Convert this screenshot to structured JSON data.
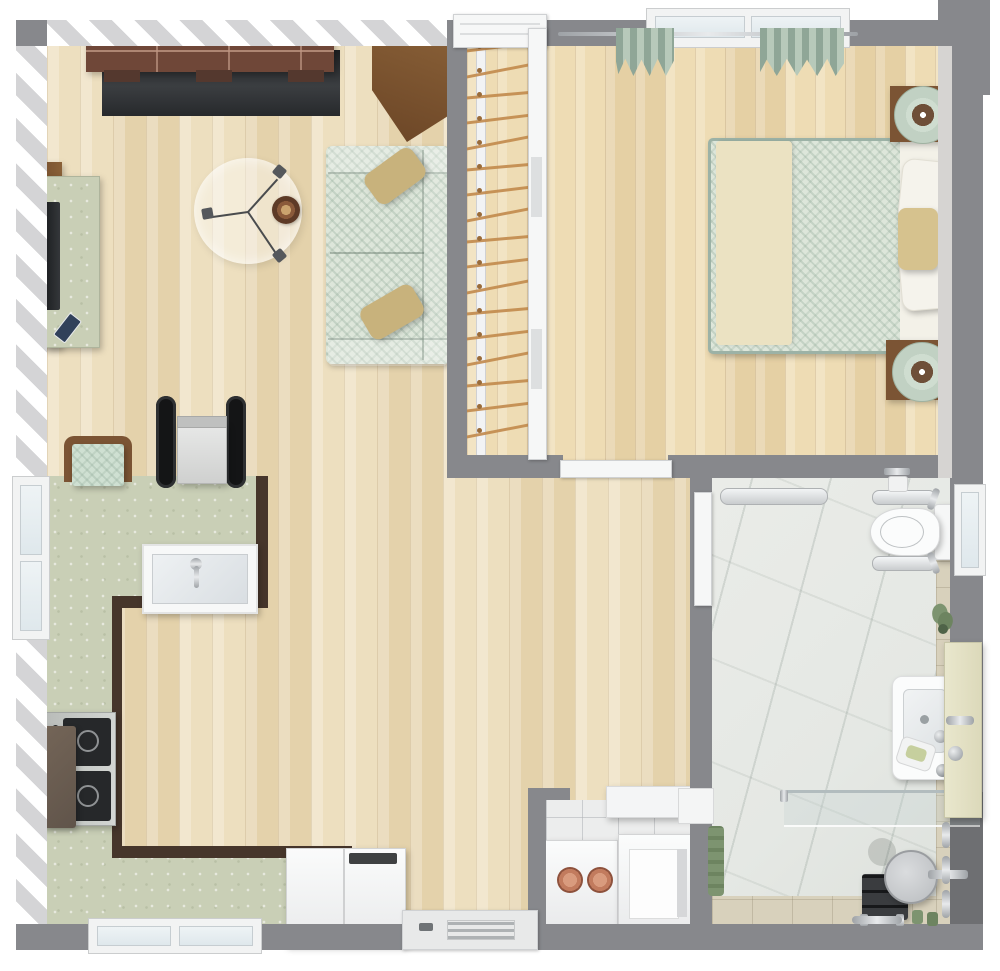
{
  "scene": {
    "title": "3D top-view floor plan — one-bedroom accessible apartment",
    "rooms": [
      {
        "name": "living-room",
        "furniture": [
          "brick fireplace mantel",
          "dark fireplace panel",
          "media sideboard",
          "flat tv",
          "remote control",
          "round glass coffee table",
          "decor bowl",
          "two-seat sofa",
          "tan throw pillows",
          "corner wood cabinet"
        ]
      },
      {
        "name": "kitchen-dining",
        "furniture": [
          "l-shaped countertop",
          "double sink with faucet",
          "gas cooktop",
          "range hood cabinet",
          "dining chair with chevron cushion",
          "wheelchair",
          "chest freezer",
          "entry door with vent"
        ]
      },
      {
        "name": "closet",
        "furniture": [
          "closet rod",
          "clothes hangers",
          "sliding door"
        ]
      },
      {
        "name": "bedroom",
        "furniture": [
          "double bed",
          "herringbone duvet",
          "cream runner",
          "white pillows",
          "tan pillow",
          "headboard",
          "nightstand x2",
          "round table lamp x2",
          "window with green curtains",
          "open door"
        ]
      },
      {
        "name": "bathroom",
        "furniture": [
          "accessible toilet",
          "fold-down grab bars",
          "toilet paper holder",
          "wall grab bar",
          "washbasin",
          "faucet",
          "soap dish",
          "vanity counter",
          "glass shower screen",
          "shower seat",
          "shower bench",
          "shower grab bars",
          "floor drain",
          "towel",
          "plant",
          "window"
        ]
      },
      {
        "name": "laundry-closet",
        "furniture": [
          "washing machine with hose connectors",
          "dryer with open lid",
          "wall shelf"
        ]
      }
    ]
  },
  "closet": {
    "hanger_count": 17
  },
  "palette": {
    "wall": "#87888c",
    "woodA": "#eddfbf",
    "woodB": "#e4d2ab",
    "woodC": "#eedcb4",
    "woodD": "#e5d0a4",
    "counter": "#c9cfb6",
    "cabEdge": "#46362b",
    "marble": "#e5e8e4",
    "tile": "#d8d1bc",
    "fabric": "#dde6da",
    "pillowTan": "#c8b27c",
    "cream": "#ebe2c2",
    "sheetWhite": "#f3f1e8",
    "woodBrown": "#7b5434",
    "woodBrownDark": "#5f3f26",
    "brick": "#6f4738",
    "dark": "#232527",
    "curtain": "#8fa697",
    "copper": "#c27b5e",
    "plant": "#7d9470",
    "seatGray": "#c9cbce",
    "applianceWhite": "#f4f5f6"
  }
}
